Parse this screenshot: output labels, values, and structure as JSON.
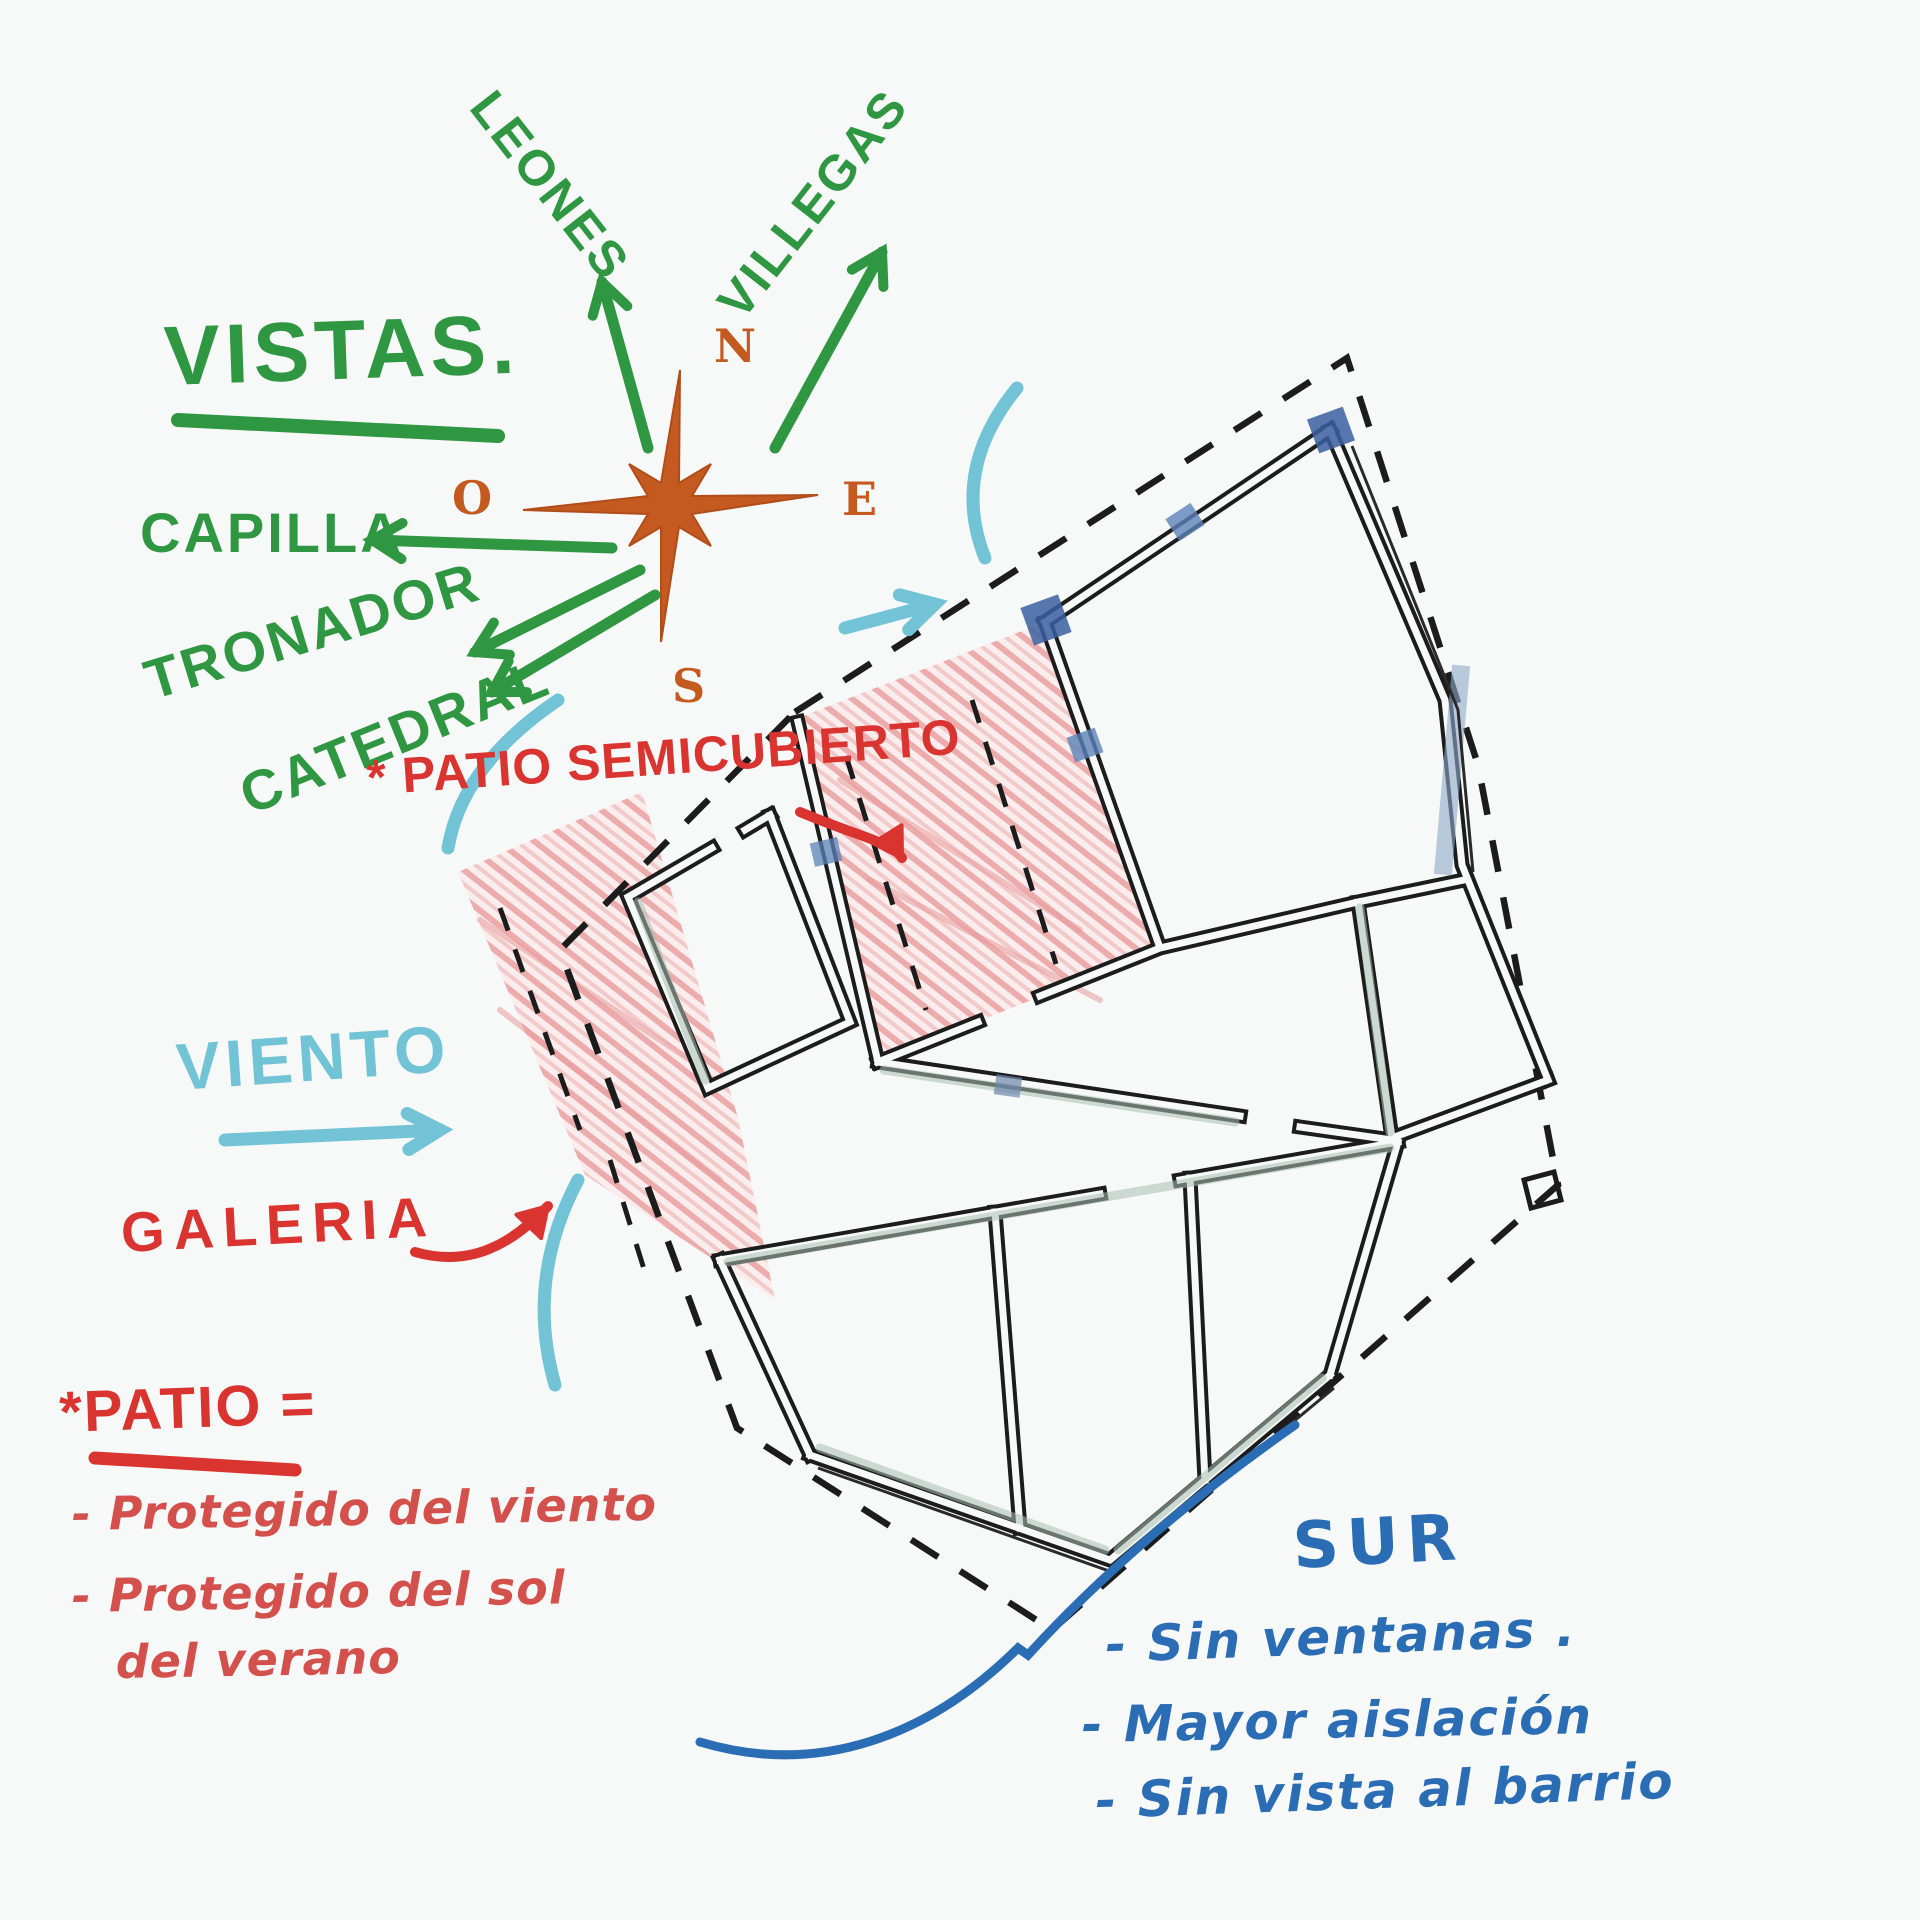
{
  "vistas": {
    "heading": "VISTAS.",
    "labels": {
      "leones": "LEONES",
      "villegas": "VILLEGAS",
      "capilla": "CAPILLA",
      "tronador": "TRONADOR",
      "catedral": "CATEDRAL"
    }
  },
  "compass": {
    "north": "N",
    "east": "E",
    "south": "S",
    "west": "O"
  },
  "wind": {
    "label": "VIENTO"
  },
  "patio_semicubierto": {
    "label": "* PATIO SEMICUBIERTO"
  },
  "galeria": {
    "label": "GALERIA"
  },
  "patio_notes": {
    "heading": "*PATIO =",
    "lines": [
      "- Protegido del viento",
      "- Protegido del sol",
      "del verano"
    ]
  },
  "sur_notes": {
    "heading": "SUR",
    "lines": [
      "- Sin ventanas .",
      "- Mayor aislación",
      "- Sin vista al barrio"
    ]
  },
  "colors": {
    "green": "#2f9642",
    "light_blue": "#72c3d6",
    "red_marker": "#d93430",
    "red_crayon": "#d4504c",
    "dark_blue": "#2a6db5",
    "orange": "#c55a21",
    "ink": "#1c1c1c"
  }
}
